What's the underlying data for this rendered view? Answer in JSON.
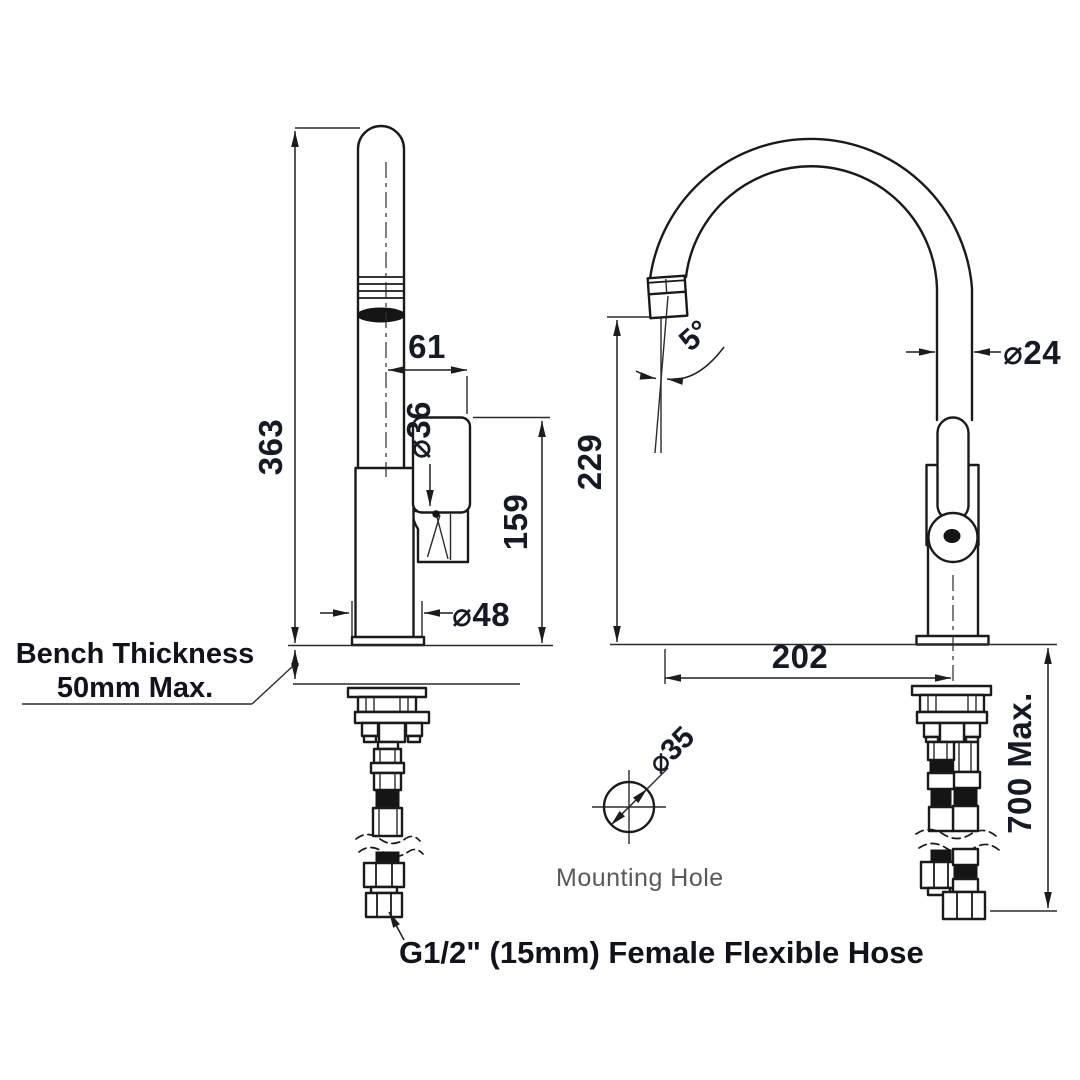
{
  "labels": {
    "bench_thickness_line1": "Bench Thickness",
    "bench_thickness_line2": "50mm Max.",
    "mounting_hole": "Mounting Hole",
    "hose_note": "G1/2\" (15mm) Female Flexible Hose"
  },
  "dimensions": {
    "overall_height": "363",
    "spout_offset": "61",
    "body_diameter": "⌀36",
    "handle_height": "159",
    "base_diameter": "⌀48",
    "spout_angle": "5°",
    "spout_clearance": "229",
    "spout_tube_diameter": "⌀24",
    "spout_reach": "202",
    "hose_length": "700 Max.",
    "mounting_hole_diameter": "⌀35"
  },
  "colors": {
    "line": "#1a1a1a",
    "dimension_text": "#151a26",
    "muted_text": "#58595b",
    "background": "#ffffff"
  }
}
